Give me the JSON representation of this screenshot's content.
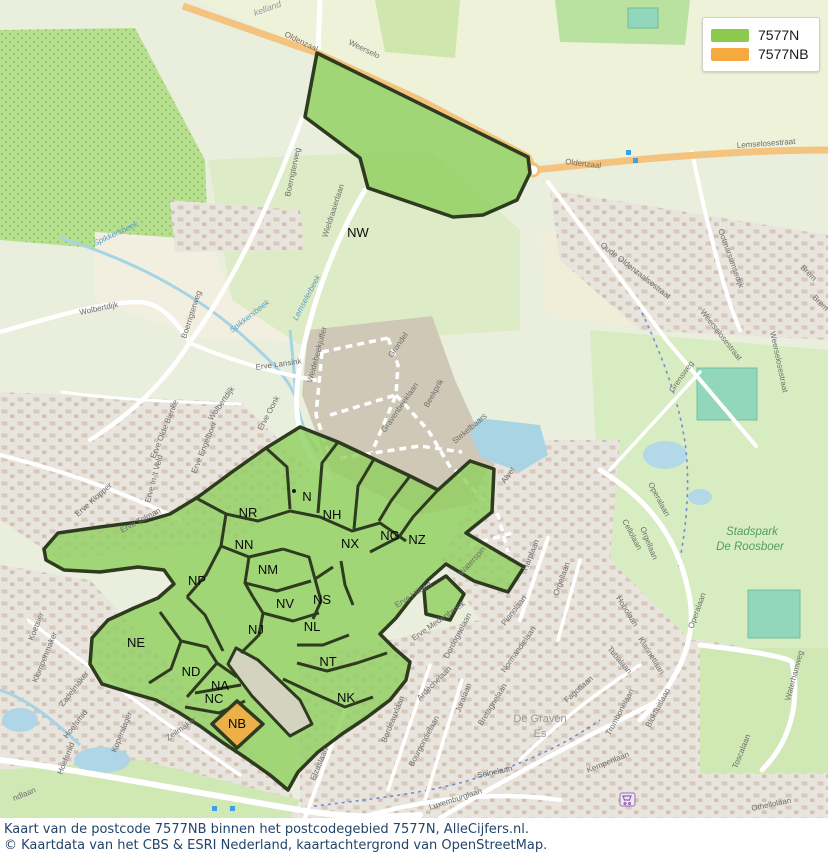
{
  "legend": {
    "items": [
      {
        "label": "7577N",
        "color": "#8cc94f"
      },
      {
        "label": "7577NB",
        "color": "#f5a93f"
      }
    ]
  },
  "caption": {
    "line1": "Kaart van de postcode 7577NB binnen het postcodegebied 7577N, AlleCijfers.nl.",
    "line2": "© Kaartdata van het CBS & ESRI Nederland, kaartachtergrond van OpenStreetMap."
  },
  "colors": {
    "postcode_fill": "#8ed05e",
    "postcode_nb_fill": "#efae44",
    "postcode_outline": "#2e3b1f",
    "water": "#a9d4e4",
    "main_road": "#f4c37d"
  },
  "map": {
    "region_labels": [
      {
        "t": "NW",
        "x": 358,
        "y": 237
      },
      {
        "t": "N",
        "x": 307,
        "y": 501
      },
      {
        "t": "NR",
        "x": 248,
        "y": 517
      },
      {
        "t": "NH",
        "x": 332,
        "y": 519
      },
      {
        "t": "NN",
        "x": 244,
        "y": 549
      },
      {
        "t": "NX",
        "x": 350,
        "y": 548
      },
      {
        "t": "NG",
        "x": 390,
        "y": 540
      },
      {
        "t": "NZ",
        "x": 417,
        "y": 544
      },
      {
        "t": "NM",
        "x": 268,
        "y": 574
      },
      {
        "t": "NP",
        "x": 197,
        "y": 585
      },
      {
        "t": "NV",
        "x": 285,
        "y": 608
      },
      {
        "t": "NS",
        "x": 322,
        "y": 604
      },
      {
        "t": "NJ",
        "x": 256,
        "y": 634
      },
      {
        "t": "NL",
        "x": 312,
        "y": 631
      },
      {
        "t": "NE",
        "x": 136,
        "y": 647
      },
      {
        "t": "NT",
        "x": 328,
        "y": 666
      },
      {
        "t": "ND",
        "x": 191,
        "y": 676
      },
      {
        "t": "NA",
        "x": 220,
        "y": 690
      },
      {
        "t": "NC",
        "x": 214,
        "y": 703
      },
      {
        "t": "NK",
        "x": 346,
        "y": 702
      },
      {
        "t": "NB",
        "x": 237,
        "y": 728
      }
    ],
    "street_labels": [
      {
        "t": "kelland",
        "x": 255,
        "y": 16,
        "r": -20,
        "c": "boundary-label"
      },
      {
        "t": "Weerselo",
        "x": 348,
        "y": 44,
        "r": 26,
        "c": "street"
      },
      {
        "t": "Oldenzaal",
        "x": 284,
        "y": 36,
        "r": 26,
        "c": "roadlbl"
      },
      {
        "t": "Oldenzaal",
        "x": 565,
        "y": 164,
        "r": 7,
        "c": "roadlbl"
      },
      {
        "t": "Lemselosestraat",
        "x": 737,
        "y": 148,
        "r": -4,
        "c": "street"
      },
      {
        "t": "Oude Oldenzaalsestraat",
        "x": 600,
        "y": 246,
        "r": 38,
        "c": "street"
      },
      {
        "t": "Ootmarsumsedijk",
        "x": 718,
        "y": 230,
        "r": 70,
        "c": "street"
      },
      {
        "t": "Weerselosestraat",
        "x": 700,
        "y": 312,
        "r": 52,
        "c": "street"
      },
      {
        "t": "Weerselosestraat",
        "x": 770,
        "y": 332,
        "r": 78,
        "c": "street"
      },
      {
        "t": "Brem",
        "x": 800,
        "y": 268,
        "r": 45,
        "c": "street"
      },
      {
        "t": "Brem",
        "x": 812,
        "y": 298,
        "r": 45,
        "c": "street"
      },
      {
        "t": "Spikkersbeek",
        "x": 95,
        "y": 246,
        "r": -25,
        "c": "water-label"
      },
      {
        "t": "Spikkersbeek",
        "x": 232,
        "y": 333,
        "r": -38,
        "c": "water-label"
      },
      {
        "t": "Wolbertdijk",
        "x": 80,
        "y": 315,
        "r": -12,
        "c": "street"
      },
      {
        "t": "Wolbertdijk",
        "x": 212,
        "y": 421,
        "r": -55,
        "c": "street"
      },
      {
        "t": "Boerrigterweg",
        "x": 290,
        "y": 197,
        "r": -78,
        "c": "street"
      },
      {
        "t": "Boerrigterweg",
        "x": 186,
        "y": 339,
        "r": -72,
        "c": "street"
      },
      {
        "t": "Erve Lansink",
        "x": 256,
        "y": 370,
        "r": -8,
        "c": "street"
      },
      {
        "t": "Erve Oonk",
        "x": 262,
        "y": 431,
        "r": -62,
        "c": "street"
      },
      {
        "t": "Erve Olde Bienke",
        "x": 155,
        "y": 459,
        "r": -68,
        "c": "street"
      },
      {
        "t": "Erve In 't Veld",
        "x": 150,
        "y": 503,
        "r": -75,
        "c": "street"
      },
      {
        "t": "Erve Klopper",
        "x": 78,
        "y": 517,
        "r": -42,
        "c": "street"
      },
      {
        "t": "Erve Tolman",
        "x": 122,
        "y": 533,
        "r": -28,
        "c": "street"
      },
      {
        "t": "Erve Engelboer",
        "x": 196,
        "y": 474,
        "r": -68,
        "c": "street"
      },
      {
        "t": "Wieldraaierlaan",
        "x": 327,
        "y": 238,
        "r": -72,
        "c": "street"
      },
      {
        "t": "Lemselerbeek",
        "x": 297,
        "y": 321,
        "r": -62,
        "c": "water-label"
      },
      {
        "t": "Weidebeekjuffer",
        "x": 312,
        "y": 383,
        "r": -75,
        "c": "street"
      },
      {
        "t": "Grondel",
        "x": 392,
        "y": 358,
        "r": -55,
        "c": "street"
      },
      {
        "t": "Gravenbeeklaan",
        "x": 385,
        "y": 433,
        "r": -55,
        "c": "street"
      },
      {
        "t": "Beekprik",
        "x": 428,
        "y": 408,
        "r": -60,
        "c": "street"
      },
      {
        "t": "Stekelbaars",
        "x": 455,
        "y": 444,
        "r": -40,
        "c": "street"
      },
      {
        "t": "Alver",
        "x": 505,
        "y": 484,
        "r": -55,
        "c": "street"
      },
      {
        "t": "Waterspin",
        "x": 462,
        "y": 576,
        "r": -48,
        "c": "street"
      },
      {
        "t": "Erve Hilbert",
        "x": 397,
        "y": 608,
        "r": -33,
        "c": "street"
      },
      {
        "t": "Erve Medenbroek",
        "x": 414,
        "y": 641,
        "r": -35,
        "c": "street"
      },
      {
        "t": "Dordognelaan",
        "x": 448,
        "y": 659,
        "r": -62,
        "c": "street"
      },
      {
        "t": "Pianolaan",
        "x": 505,
        "y": 626,
        "r": -52,
        "c": "street"
      },
      {
        "t": "Normandielaan",
        "x": 505,
        "y": 673,
        "r": -55,
        "c": "street"
      },
      {
        "t": "Operalaan",
        "x": 648,
        "y": 484,
        "r": 62,
        "c": "street"
      },
      {
        "t": "Operalaan",
        "x": 693,
        "y": 629,
        "r": -70,
        "c": "street"
      },
      {
        "t": "Cellolaan",
        "x": 622,
        "y": 521,
        "r": 62,
        "c": "street"
      },
      {
        "t": "Orgellaan",
        "x": 640,
        "y": 528,
        "r": 68,
        "c": "street"
      },
      {
        "t": "Orgellaan",
        "x": 558,
        "y": 596,
        "r": -70,
        "c": "street"
      },
      {
        "t": "Harplaan",
        "x": 527,
        "y": 571,
        "r": -68,
        "c": "street"
      },
      {
        "t": "Hobolaan",
        "x": 616,
        "y": 598,
        "r": 58,
        "c": "street"
      },
      {
        "t": "Klarinetlaan",
        "x": 638,
        "y": 639,
        "r": 58,
        "c": "street"
      },
      {
        "t": "Tubalaan",
        "x": 607,
        "y": 649,
        "r": 50,
        "c": "street"
      },
      {
        "t": "Grensweg",
        "x": 673,
        "y": 393,
        "r": -55,
        "c": "street"
      },
      {
        "t": "Fagotlaan",
        "x": 567,
        "y": 703,
        "r": -42,
        "c": "street"
      },
      {
        "t": "Trombonelaan",
        "x": 610,
        "y": 736,
        "r": -62,
        "c": "street"
      },
      {
        "t": "Blokfluitlaan",
        "x": 650,
        "y": 728,
        "r": -62,
        "c": "street"
      },
      {
        "t": "Waterhamweg",
        "x": 790,
        "y": 701,
        "r": -75,
        "c": "street"
      },
      {
        "t": "Toscalaan",
        "x": 737,
        "y": 769,
        "r": -68,
        "c": "street"
      },
      {
        "t": "Othellolaan",
        "x": 752,
        "y": 811,
        "r": -12,
        "c": "street"
      },
      {
        "t": "Kempenlaan",
        "x": 588,
        "y": 773,
        "r": -22,
        "c": "street"
      },
      {
        "t": "Seinelaan",
        "x": 478,
        "y": 778,
        "r": -12,
        "c": "street"
      },
      {
        "t": "Bretagnelaan",
        "x": 482,
        "y": 726,
        "r": -58,
        "c": "street"
      },
      {
        "t": "Juralaan",
        "x": 460,
        "y": 713,
        "r": -68,
        "c": "street"
      },
      {
        "t": "Luxemburglaan",
        "x": 430,
        "y": 810,
        "r": -18,
        "c": "street"
      },
      {
        "t": "Elzaslaan",
        "x": 315,
        "y": 781,
        "r": -68,
        "c": "street"
      },
      {
        "t": "Bordeauxlaan",
        "x": 386,
        "y": 743,
        "r": -68,
        "c": "street"
      },
      {
        "t": "Bourgondielaan",
        "x": 413,
        "y": 767,
        "r": -62,
        "c": "street"
      },
      {
        "t": "Ardèchelaan",
        "x": 420,
        "y": 701,
        "r": -45,
        "c": "street"
      },
      {
        "t": "Koetsier",
        "x": 33,
        "y": 641,
        "r": -68,
        "c": "street"
      },
      {
        "t": "Klompenmaker",
        "x": 37,
        "y": 683,
        "r": -68,
        "c": "street"
      },
      {
        "t": "Zadelmaker",
        "x": 63,
        "y": 707,
        "r": -52,
        "c": "street"
      },
      {
        "t": "Hoefsmid",
        "x": 67,
        "y": 739,
        "r": -52,
        "c": "street"
      },
      {
        "t": "Hoefsmid",
        "x": 62,
        "y": 775,
        "r": -68,
        "c": "street"
      },
      {
        "t": "Koperslager",
        "x": 116,
        "y": 753,
        "r": -68,
        "c": "street"
      },
      {
        "t": "Zeilmaker",
        "x": 168,
        "y": 741,
        "r": -35,
        "c": "street"
      },
      {
        "t": "ndlaan",
        "x": 14,
        "y": 801,
        "r": -22,
        "c": "street"
      }
    ],
    "place_labels": [
      {
        "t": "Stadspark",
        "x": 752,
        "y": 535,
        "c": "park-label"
      },
      {
        "t": "De Roosboer",
        "x": 750,
        "y": 550,
        "c": "park-label"
      },
      {
        "t": "De Graven",
        "x": 540,
        "y": 722,
        "c": "area-label"
      },
      {
        "t": "Es",
        "x": 540,
        "y": 737,
        "c": "area-label"
      }
    ]
  }
}
